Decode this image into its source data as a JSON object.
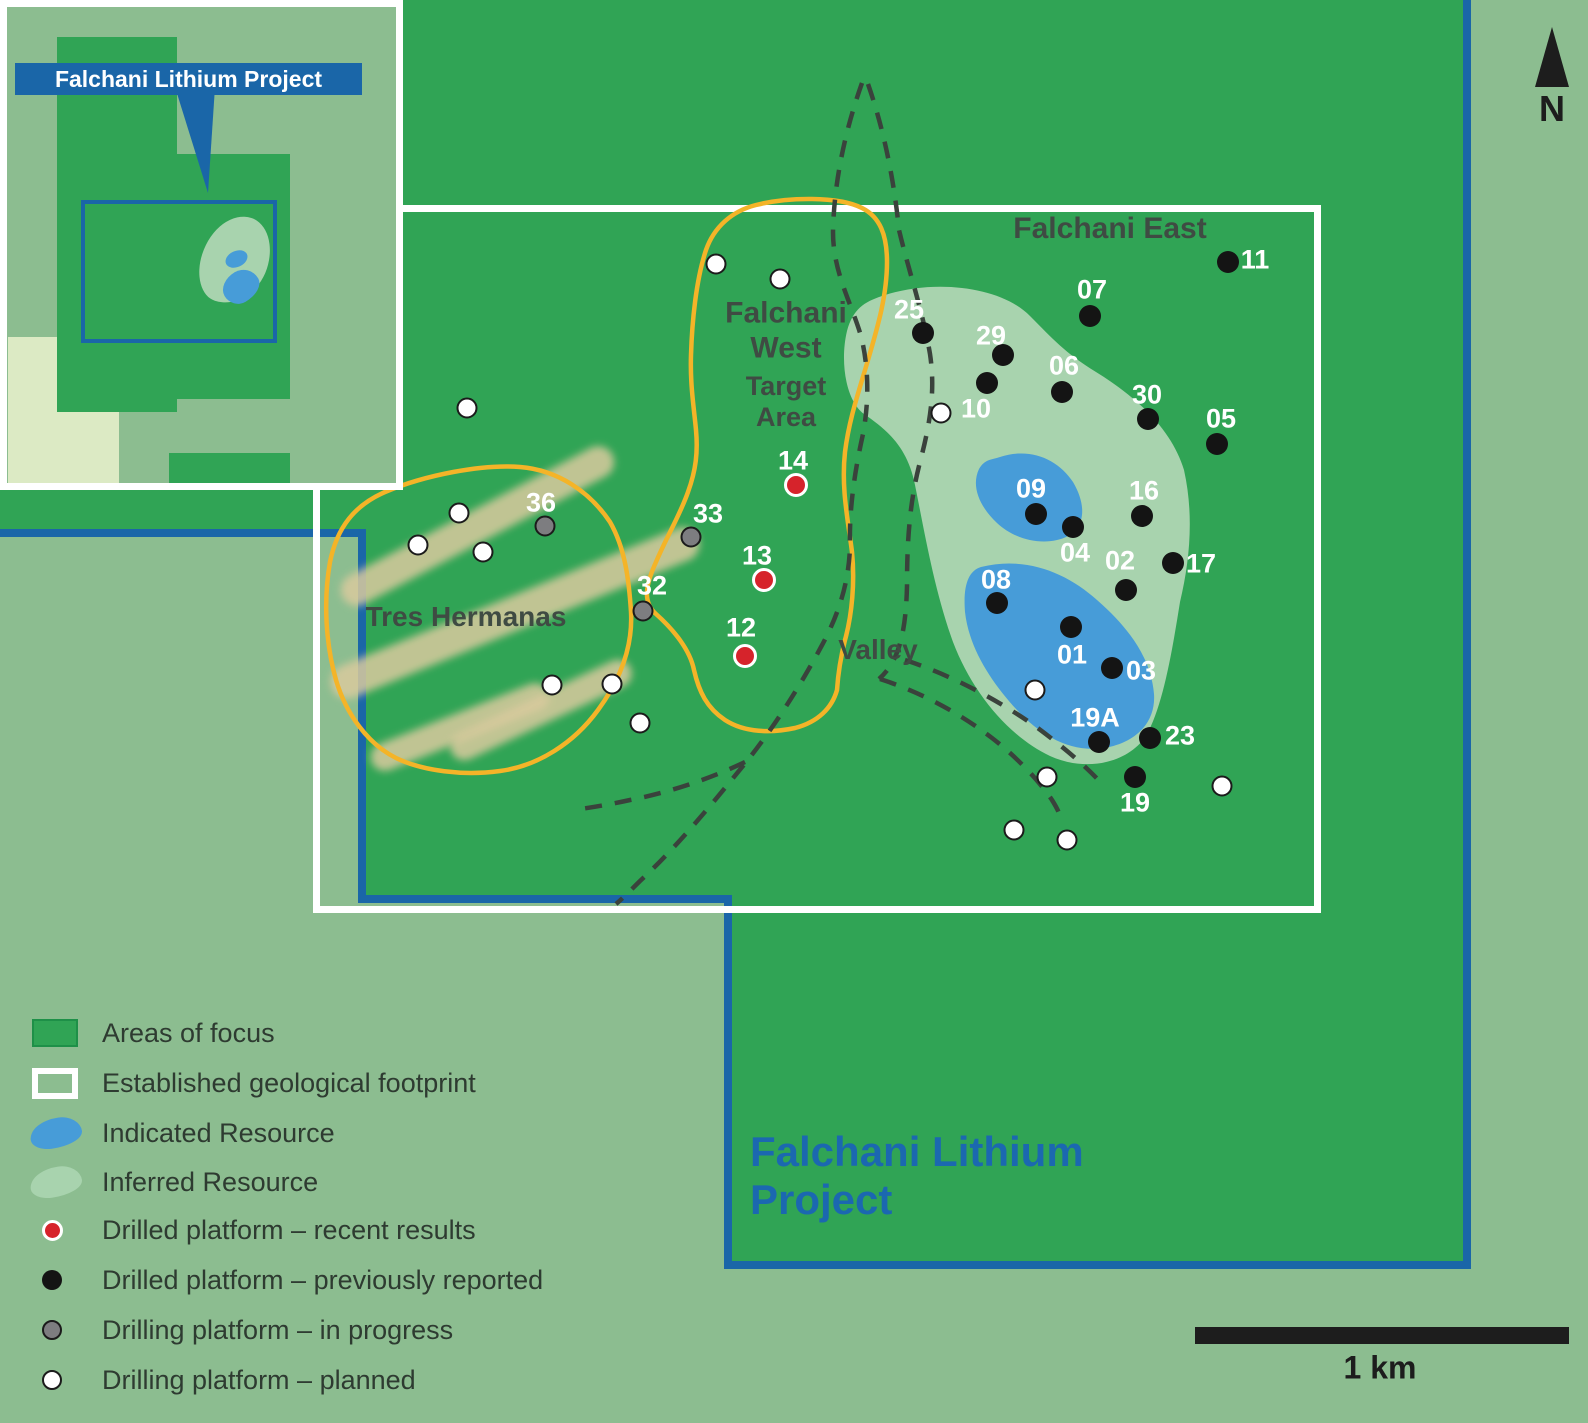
{
  "inset": {
    "title": "Falchani Lithium Project"
  },
  "compass": {
    "label": "N"
  },
  "scale": {
    "label": "1 km"
  },
  "title": {
    "line1": "Falchani Lithium",
    "line2": "Project"
  },
  "legend": {
    "items": [
      {
        "swatch": "area",
        "label": "Areas of focus"
      },
      {
        "swatch": "footprint",
        "label": "Established geological footprint"
      },
      {
        "swatch": "indicated",
        "label": "Indicated Resource"
      },
      {
        "swatch": "inferred",
        "label": "Inferred Resource"
      },
      {
        "swatch": "recent",
        "label": "Drilled platform – recent results"
      },
      {
        "swatch": "previous",
        "label": "Drilled platform – previously reported"
      },
      {
        "swatch": "progress",
        "label": "Drilling platform – in progress"
      },
      {
        "swatch": "planned",
        "label": "Drilling platform – planned"
      }
    ]
  },
  "map": {
    "region_labels": [
      {
        "id": "falchani-east",
        "lines": [
          "Falchani East"
        ],
        "x": 1110,
        "y": 229,
        "size": 30
      },
      {
        "id": "falchani-west",
        "lines": [
          "Falchani",
          "West"
        ],
        "x": 786,
        "y": 331,
        "size": 30
      },
      {
        "id": "target-area",
        "lines": [
          "Target",
          "Area"
        ],
        "x": 786,
        "y": 402,
        "size": 27
      },
      {
        "id": "tres-hermanas",
        "lines": [
          "Tres Hermanas"
        ],
        "x": 466,
        "y": 617,
        "size": 28
      },
      {
        "id": "valley",
        "lines": [
          "Valley"
        ],
        "x": 878,
        "y": 650,
        "size": 28
      }
    ],
    "markers": [
      {
        "type": "recent",
        "label": "14",
        "x": 796,
        "y": 485,
        "lx": 793,
        "ly": 461
      },
      {
        "type": "recent",
        "label": "13",
        "x": 764,
        "y": 580,
        "lx": 757,
        "ly": 556
      },
      {
        "type": "recent",
        "label": "12",
        "x": 745,
        "y": 656,
        "lx": 741,
        "ly": 628
      },
      {
        "type": "progress",
        "label": "36",
        "x": 545,
        "y": 526,
        "lx": 541,
        "ly": 503
      },
      {
        "type": "progress",
        "label": "33",
        "x": 691,
        "y": 537,
        "lx": 708,
        "ly": 514
      },
      {
        "type": "progress",
        "label": "32",
        "x": 643,
        "y": 611,
        "lx": 652,
        "ly": 586
      },
      {
        "type": "previous",
        "label": "25",
        "x": 923,
        "y": 333,
        "lx": 909,
        "ly": 310
      },
      {
        "type": "previous",
        "label": "29",
        "x": 1003,
        "y": 355,
        "lx": 991,
        "ly": 336
      },
      {
        "type": "previous",
        "label": "",
        "x": 987,
        "y": 383
      },
      {
        "type": "previous",
        "label": "07",
        "x": 1090,
        "y": 316,
        "lx": 1092,
        "ly": 290
      },
      {
        "type": "previous",
        "label": "11",
        "x": 1228,
        "y": 262,
        "lx": 1255,
        "ly": 260
      },
      {
        "type": "previous",
        "label": "06",
        "x": 1062,
        "y": 392,
        "lx": 1064,
        "ly": 366
      },
      {
        "type": "previous",
        "label": "30",
        "x": 1148,
        "y": 419,
        "lx": 1147,
        "ly": 395
      },
      {
        "type": "previous",
        "label": "05",
        "x": 1217,
        "y": 444,
        "lx": 1221,
        "ly": 419
      },
      {
        "type": "previous",
        "label": "09",
        "x": 1036,
        "y": 514,
        "lx": 1031,
        "ly": 489
      },
      {
        "type": "previous",
        "label": "04",
        "x": 1073,
        "y": 527,
        "lx": 1075,
        "ly": 553
      },
      {
        "type": "previous",
        "label": "16",
        "x": 1142,
        "y": 516,
        "lx": 1144,
        "ly": 491
      },
      {
        "type": "previous",
        "label": "02",
        "x": 1126,
        "y": 590,
        "lx": 1120,
        "ly": 561
      },
      {
        "type": "previous",
        "label": "17",
        "x": 1173,
        "y": 563,
        "lx": 1201,
        "ly": 564
      },
      {
        "type": "previous",
        "label": "08",
        "x": 997,
        "y": 603,
        "lx": 996,
        "ly": 580
      },
      {
        "type": "previous",
        "label": "01",
        "x": 1071,
        "y": 627,
        "lx": 1072,
        "ly": 655
      },
      {
        "type": "previous",
        "label": "03",
        "x": 1112,
        "y": 668,
        "lx": 1141,
        "ly": 671
      },
      {
        "type": "previous",
        "label": "19A",
        "x": 1099,
        "y": 742,
        "lx": 1095,
        "ly": 718
      },
      {
        "type": "previous",
        "label": "23",
        "x": 1150,
        "y": 738,
        "lx": 1180,
        "ly": 736
      },
      {
        "type": "previous",
        "label": "19",
        "x": 1135,
        "y": 777,
        "lx": 1135,
        "ly": 803
      },
      {
        "type": "planned",
        "label": "10",
        "x": 941,
        "y": 413,
        "lx": 976,
        "ly": 409
      },
      {
        "type": "planned",
        "label": "",
        "x": 716,
        "y": 264
      },
      {
        "type": "planned",
        "label": "",
        "x": 780,
        "y": 279
      },
      {
        "type": "planned",
        "label": "",
        "x": 467,
        "y": 408
      },
      {
        "type": "planned",
        "label": "",
        "x": 459,
        "y": 513
      },
      {
        "type": "planned",
        "label": "",
        "x": 418,
        "y": 545
      },
      {
        "type": "planned",
        "label": "",
        "x": 483,
        "y": 552
      },
      {
        "type": "planned",
        "label": "",
        "x": 552,
        "y": 685
      },
      {
        "type": "planned",
        "label": "",
        "x": 612,
        "y": 684
      },
      {
        "type": "planned",
        "label": "",
        "x": 640,
        "y": 723
      },
      {
        "type": "planned",
        "label": "",
        "x": 1035,
        "y": 690
      },
      {
        "type": "planned",
        "label": "",
        "x": 1047,
        "y": 777
      },
      {
        "type": "planned",
        "label": "",
        "x": 1222,
        "y": 786
      },
      {
        "type": "planned",
        "label": "",
        "x": 1014,
        "y": 830
      },
      {
        "type": "planned",
        "label": "",
        "x": 1067,
        "y": 840
      }
    ]
  },
  "colors": {
    "sage": "#8CBD90",
    "green_dark": "#30A455",
    "cream": "#DCEAC4",
    "inferred": "#A8D3AE",
    "indicated": "#479CD8",
    "yellow": "#F4B428",
    "blue_line": "#1A66A8",
    "blue_title": "#1B68B0",
    "dash": "#3A423C",
    "ink_label": "#3F4B43",
    "ink_legend": "#2E3B31",
    "red_dot": "#D6232B",
    "gray_dot": "#7D7D80"
  }
}
